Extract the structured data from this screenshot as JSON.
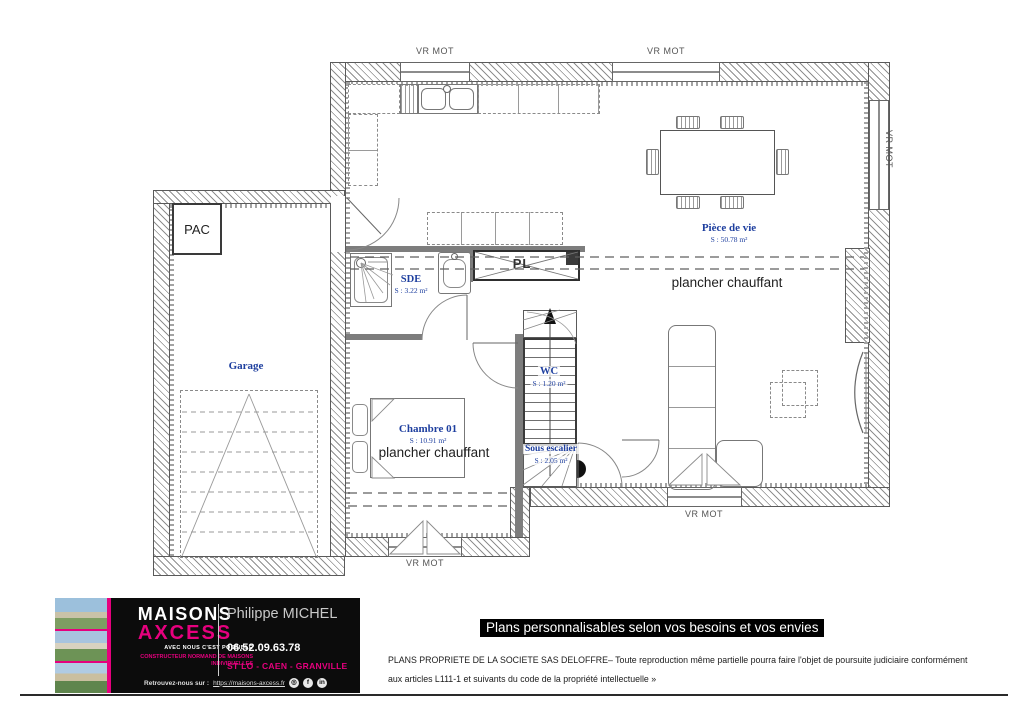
{
  "plan": {
    "shutters": {
      "top_left": "VR MOT",
      "top_right": "VR MOT",
      "right": "VR MOT",
      "bottom_right": "VR MOT",
      "bottom_left": "VR MOT"
    },
    "rooms": {
      "piece_de_vie": {
        "name": "Pièce de vie",
        "area": "S : 50.78 m²"
      },
      "sde": {
        "name": "SDE",
        "area": "S : 3.22 m²"
      },
      "wc": {
        "name": "WC",
        "area": "S : 1.20 m²"
      },
      "chambre": {
        "name": "Chambre 01",
        "area": "S : 10.91 m²"
      },
      "sous_escalier": {
        "name": "Sous escalier",
        "area": "S : 2.05 m²"
      },
      "garage": {
        "name": "Garage"
      }
    },
    "annotations": {
      "pac": "PAC",
      "pl": "PL",
      "heating_living": "plancher chauffant",
      "heating_chambre": "plancher chauffant"
    }
  },
  "footer": {
    "brand": "MAISONS",
    "brand2": "AXCESS",
    "tagline": "AVEC NOUS C'EST POSSIBLE",
    "subtitle": "CONSTRUCTEUR NORMAND DE MAISONS INDIVIDUELLES",
    "agent_name": "Philippe MICHEL",
    "phone": "06.52.09.63.78",
    "cities": "ST LO - CAEN - GRANVILLE",
    "find_us": "Retrouvez-nous sur :",
    "website": "https://maisons-axcess.fr",
    "social": {
      "instagram": "◎",
      "facebook": "f",
      "linkedin": "in"
    }
  },
  "banner": {
    "title": "Plans personnalisables selon vos besoins et vos envies"
  },
  "legal": {
    "line1": "PLANS PROPRIETE DE LA SOCIETE SAS DELOFFRE– Toute reproduction même partielle pourra faire l'objet de poursuite judiciaire conformément",
    "line2": "aux articles L111-1 et suivants du code de la propriété intellectuelle »"
  },
  "colors": {
    "accent_pink": "#e6007e",
    "label_blue": "#1e3f9f"
  }
}
